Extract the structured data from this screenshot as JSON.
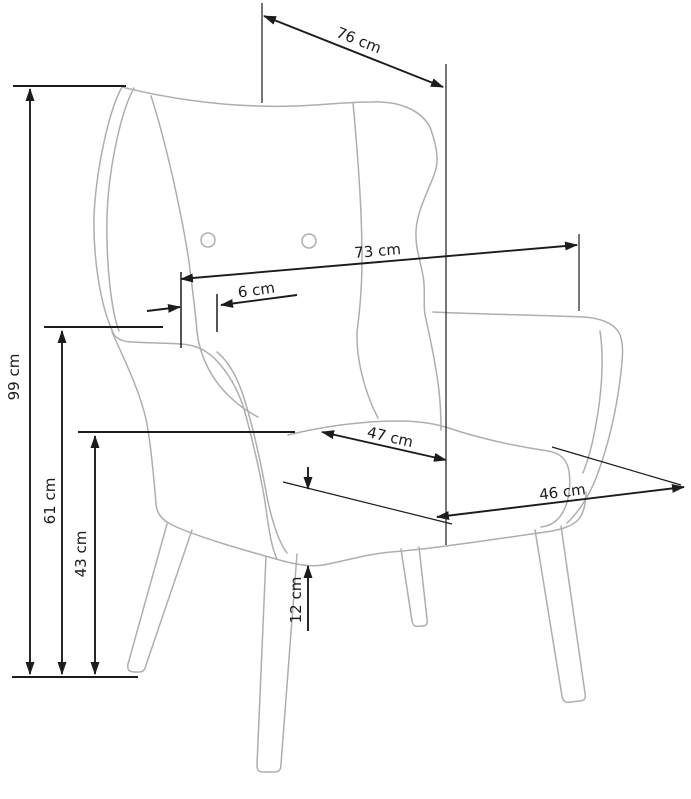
{
  "diagram": {
    "subject": "wingback armchair dimension drawing",
    "unit": "cm",
    "background_color": "#ffffff",
    "outline_color": "#aeaeae",
    "dimension_color": "#1c1c1c"
  },
  "dimensions": {
    "total_depth": {
      "label": "76 cm",
      "value": 76
    },
    "back_width": {
      "label": "73 cm",
      "value": 73
    },
    "wing_thickness": {
      "label": "6 cm",
      "value": 6
    },
    "total_height": {
      "label": "99 cm",
      "value": 99
    },
    "armrest_height": {
      "label": "61 cm",
      "value": 61
    },
    "seat_height": {
      "label": "43 cm",
      "value": 43
    },
    "seat_width": {
      "label": "47 cm",
      "value": 47
    },
    "seat_depth": {
      "label": "46 cm",
      "value": 46
    },
    "cushion_thickness": {
      "label": "12 cm",
      "value": 12
    }
  }
}
